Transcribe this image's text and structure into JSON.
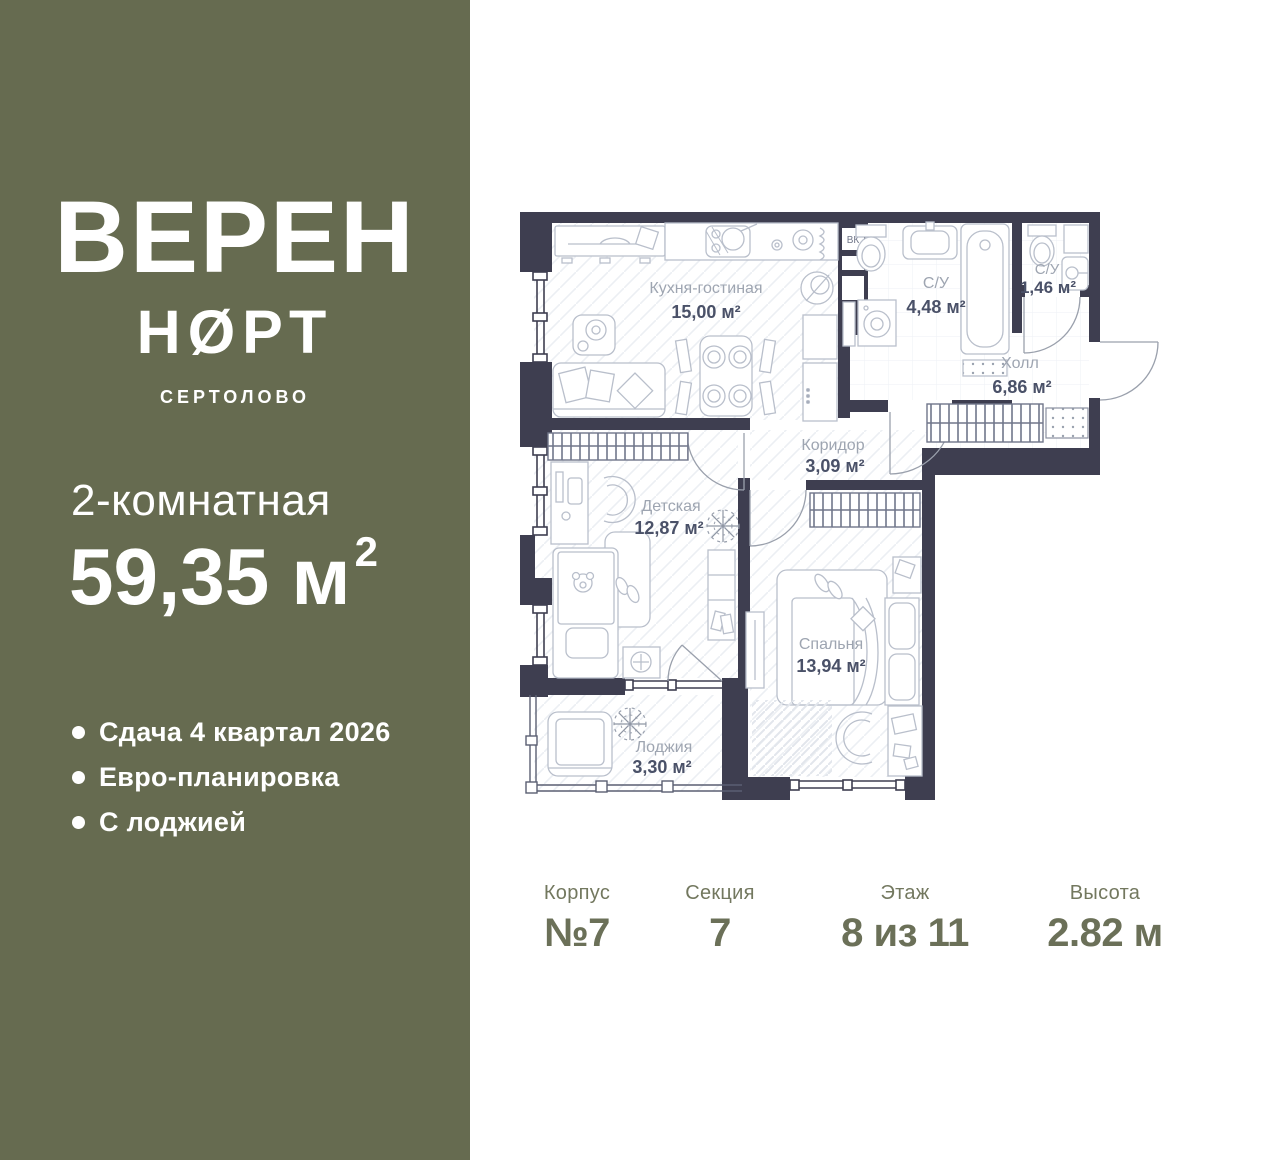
{
  "sidebar": {
    "bg_color": "#666B50",
    "logo": {
      "line1": "ВЕРЕН",
      "line2": "НØРТ",
      "subtitle": "СЕРТОЛОВО"
    },
    "rooms_line": "2-комнатная",
    "area_value": "59,35 м",
    "area_sup": "2",
    "features": [
      {
        "label": "Сдача 4 квартал 2026"
      },
      {
        "label": "Евро-планировка"
      },
      {
        "label": "С лоджией"
      }
    ]
  },
  "plan": {
    "wall_color": "#3E3E50",
    "room_name_color": "#9EA5B1",
    "room_area_color": "#4A5168",
    "duct_label": "ВК",
    "rooms": [
      {
        "name": "Кухня-гостиная",
        "area": "15,00 м²"
      },
      {
        "name": "С/У",
        "area": "4,48 м²"
      },
      {
        "name": "С/У",
        "area": "1,46 м²"
      },
      {
        "name": "Холл",
        "area": "6,86 м²"
      },
      {
        "name": "Коридор",
        "area": "3,09 м²"
      },
      {
        "name": "Детская",
        "area": "12,87 м²"
      },
      {
        "name": "Спальня",
        "area": "13,94 м²"
      },
      {
        "name": "Лоджия",
        "area": "3,30 м²"
      }
    ]
  },
  "footer": {
    "items": [
      {
        "label": "Корпус",
        "value": "№7"
      },
      {
        "label": "Секция",
        "value": "7"
      },
      {
        "label": "Этаж",
        "value": "8 из 11"
      },
      {
        "label": "Высота",
        "value": "2.82 м"
      }
    ]
  }
}
